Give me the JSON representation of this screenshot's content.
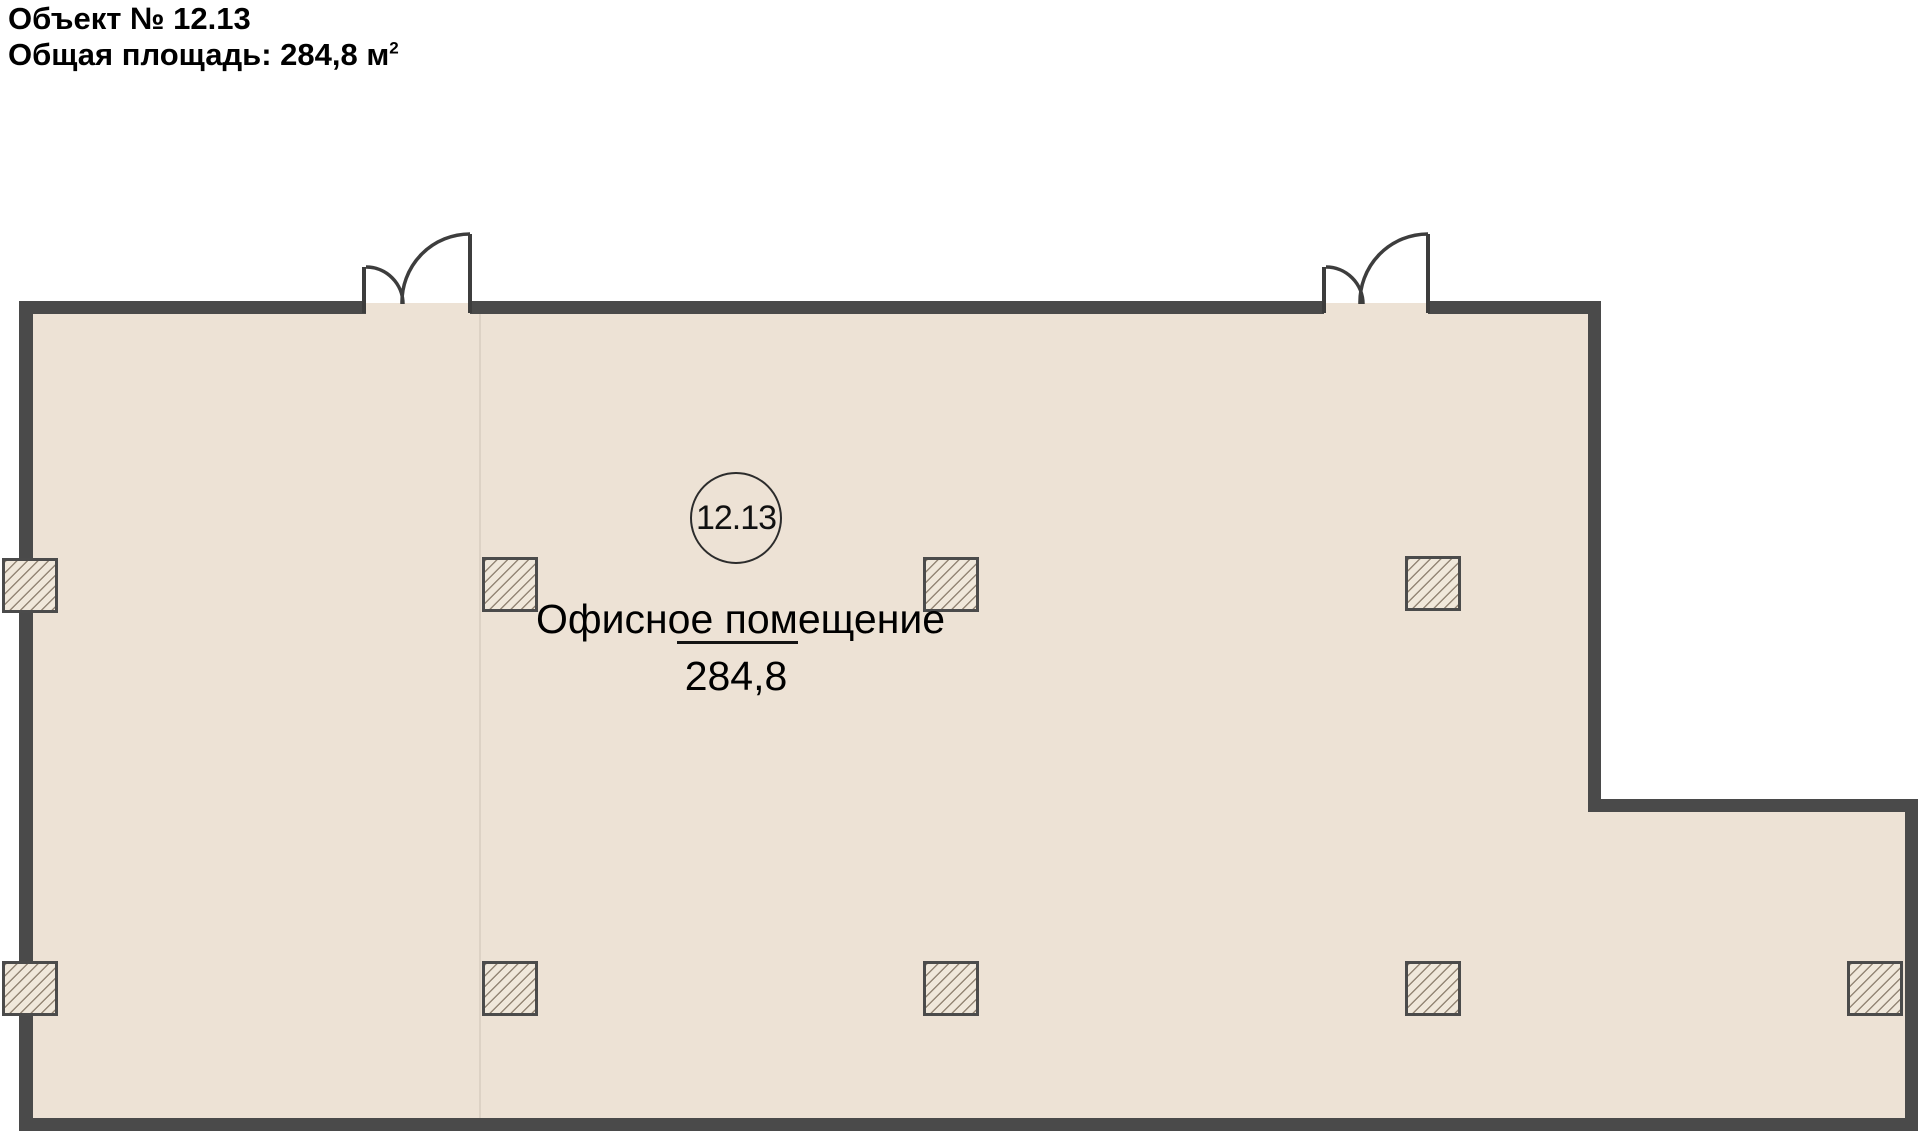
{
  "header": {
    "object_title": "Объект № 12.13",
    "area_label": "Общая площадь: 284,8 м",
    "area_superscript": "2"
  },
  "plan": {
    "room_number": "12.13",
    "room_name": "Офисное помещение",
    "room_area": "284,8"
  },
  "colors": {
    "wall": "#4a4a4a",
    "floor": "#ede2d5",
    "hatch": "#8d8071"
  }
}
